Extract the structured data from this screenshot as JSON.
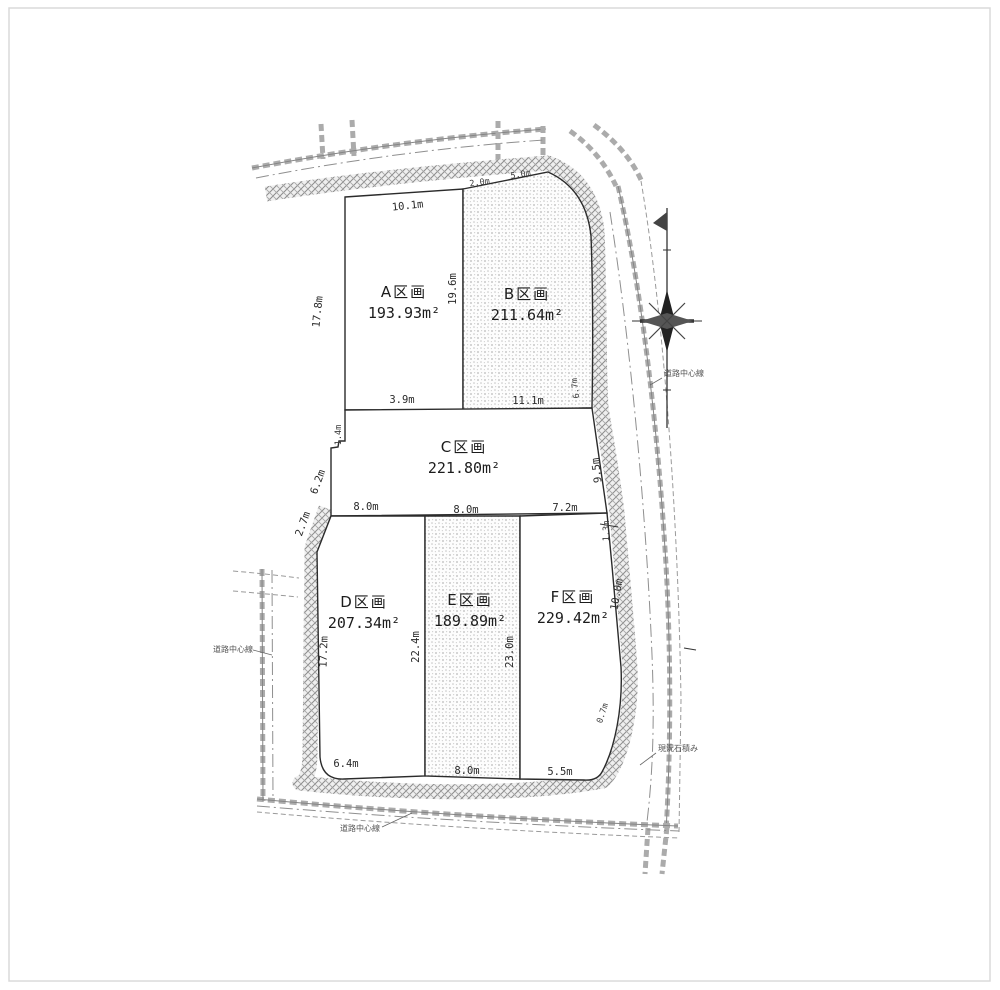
{
  "page": {
    "background": "#ffffff",
    "border_color": "#dadada"
  },
  "plots": [
    {
      "id": "A",
      "label": "A区画",
      "area": "193.93m²",
      "fill": "white"
    },
    {
      "id": "B",
      "label": "B区画",
      "area": "211.64m²",
      "fill": "stipple"
    },
    {
      "id": "C",
      "label": "C区画",
      "area": "221.80m²",
      "fill": "white"
    },
    {
      "id": "D",
      "label": "D区画",
      "area": "207.34m²",
      "fill": "white"
    },
    {
      "id": "E",
      "label": "E区画",
      "area": "189.89m²",
      "fill": "stipple"
    },
    {
      "id": "F",
      "label": "F区画",
      "area": "229.42m²",
      "fill": "white"
    }
  ],
  "dims": {
    "a_top": "10.1m",
    "b_top_1": "2.0m",
    "b_top_2": "5.0m",
    "ab_divider": "19.6m",
    "a_left": "17.8m",
    "a_bottom": "3.9m",
    "b_bottom": "11.1m",
    "b_right": "6.7m",
    "c_left_jog": "1.4m",
    "c_left_upper": "6.2m",
    "c_left_lower": "2.7m",
    "c_right": "9.5m",
    "c_bottom_left": "8.0m",
    "c_bottom_center": "8.0m",
    "c_bottom_right": "7.2m",
    "d_left": "17.2m",
    "de_divider": "22.4m",
    "ef_divider": "23.0m",
    "f_right_upper": "10.0m",
    "f_right_mid": "1.3m",
    "f_right_lower": "0.7m",
    "d_bottom": "6.4m",
    "e_bottom": "8.0m",
    "f_bottom": "5.5m"
  },
  "annotations": {
    "left_road": "道路中心線",
    "bottom_road": "道路中心線",
    "right_road": "道路中心線",
    "right_wall": "現況石積み"
  },
  "icons": {
    "compass": "compass-north-icon"
  },
  "colors": {
    "line": "#2b2b2b",
    "hatch": "#8c8c8c",
    "stipple": "#bdbdbd",
    "road": "#9a9a9a"
  }
}
